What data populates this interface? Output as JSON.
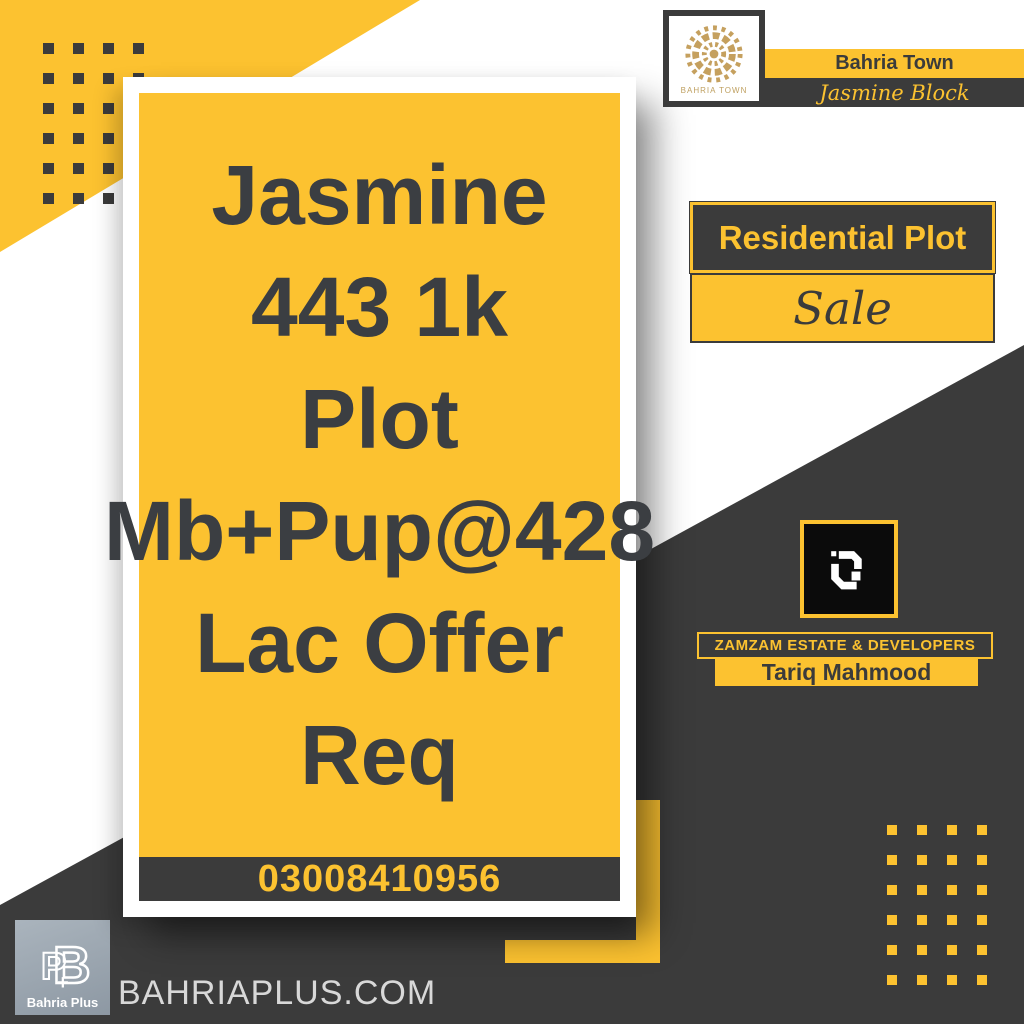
{
  "poster": {
    "header": {
      "logo_caption": "BAHRIA TOWN",
      "brand": "Bahria Town",
      "block": "Jasmine Block"
    },
    "listing": {
      "type": "Residential Plot",
      "status": "Sale"
    },
    "card": {
      "headline_lines": [
        "Jasmine",
        "443 1k",
        "Plot",
        "Mb+Pup@428",
        "Lac Offer",
        "Req"
      ],
      "phone": "03008410956"
    },
    "agency": {
      "name": "ZAMZAM ESTATE & DEVELOPERS",
      "agent": "Tariq Mahmood"
    },
    "footer": {
      "site": "BAHRIAPLUS.COM",
      "logo_text": "Bahria Plus"
    },
    "colors": {
      "yellow": "#fcc230",
      "dark": "#3b3b3b",
      "headline_text": "#3b3e42",
      "gold": "#bfa060",
      "logo_black": "#0b0b0b",
      "footer_logo_bg": "#9aa5b0",
      "site_text": "#d8d8d8",
      "white": "#ffffff"
    }
  }
}
